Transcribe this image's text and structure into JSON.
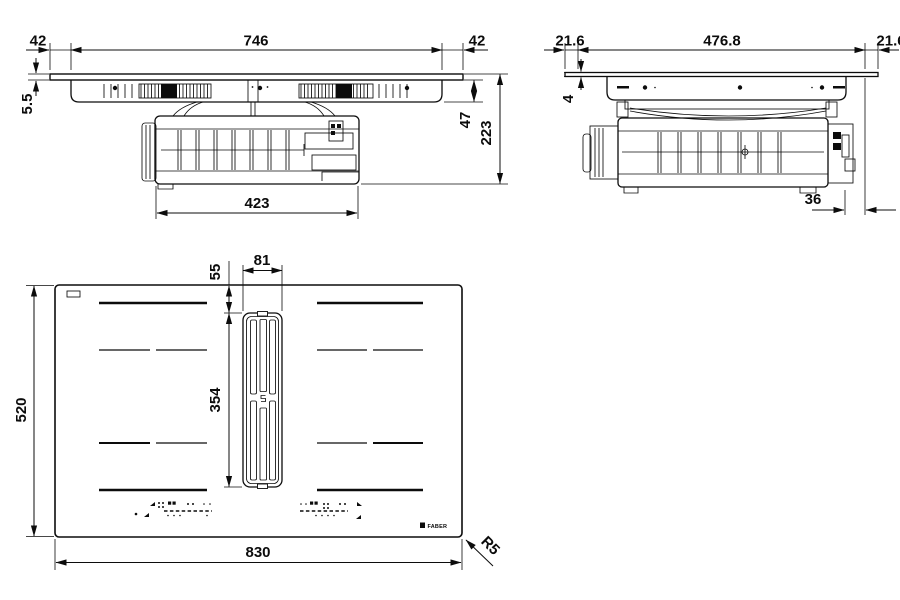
{
  "front_view": {
    "overhang_left": "42",
    "glass_width": "746",
    "overhang_right": "42",
    "glass_thickness": "5.5",
    "recess_height": "47",
    "total_height": "223",
    "unit_width": "423"
  },
  "side_view": {
    "overhang_left": "21.6",
    "glass_depth": "476.8",
    "overhang_right": "21.6",
    "glass_height": "4",
    "rear_offset": "36"
  },
  "top_view": {
    "grille_top_offset": "55",
    "grille_width": "81",
    "hob_depth": "520",
    "grille_length": "354",
    "hob_width": "830",
    "corner_radius": "R5",
    "brand": "FABER"
  }
}
